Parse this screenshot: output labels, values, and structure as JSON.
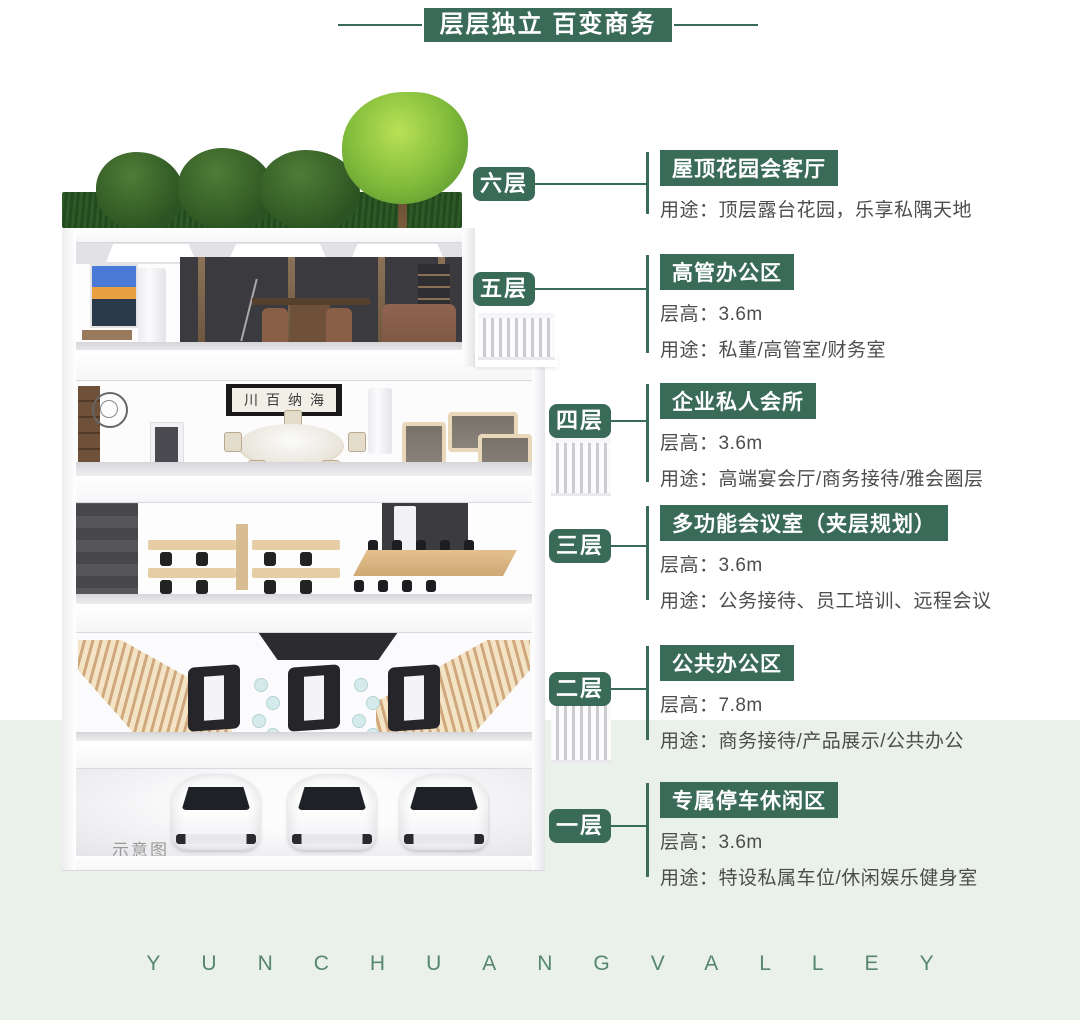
{
  "banner": {
    "title": "层层独立 百变商务"
  },
  "brand": {
    "text": "YUNCHUANGVALLEY"
  },
  "building": {
    "watermark": "示意图",
    "artwork_text": "川百纳海"
  },
  "colors": {
    "accent_green": "#3a6b58",
    "footer_bg": "#e9f1ea",
    "text_gray": "#4d4d4d"
  },
  "floors": [
    {
      "badge": "六层",
      "name": "屋顶花园会客厅",
      "usage": "用途：顶层露台花园，乐享私隅天地"
    },
    {
      "badge": "五层",
      "name": "高管办公区",
      "height": "层高：3.6m",
      "usage": "用途：私董/高管室/财务室"
    },
    {
      "badge": "四层",
      "name": "企业私人会所",
      "height": "层高：3.6m",
      "usage": "用途：高端宴会厅/商务接待/雅会圈层"
    },
    {
      "badge": "三层",
      "name": "多功能会议室（夹层规划）",
      "height": "层高：3.6m",
      "usage": "用途：公务接待、员工培训、远程会议"
    },
    {
      "badge": "二层",
      "name": "公共办公区",
      "height": "层高：7.8m",
      "usage": "用途：商务接待/产品展示/公共办公"
    },
    {
      "badge": "一层",
      "name": "专属停车休闲区",
      "height": "层高：3.6m",
      "usage": "用途：特设私属车位/休闲娱乐健身室"
    }
  ]
}
